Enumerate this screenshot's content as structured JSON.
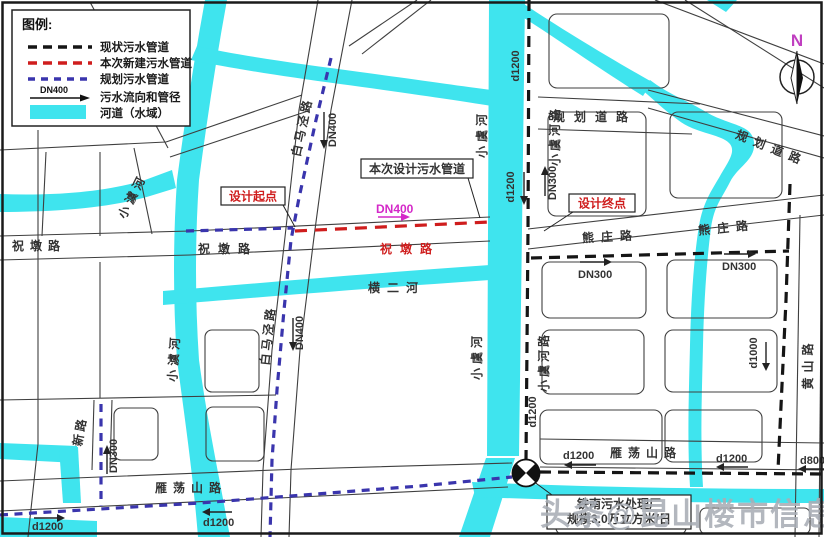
{
  "legend": {
    "title": "图例:",
    "existing": "现状污水管道",
    "new_build": "本次新建污水管道",
    "planned": "规划污水管道",
    "flow": "污水流向和管径",
    "flow_pipe": "DN400",
    "river": "河道（水域）",
    "colors": {
      "existing": "#151515",
      "new_build": "#cf1d1d",
      "planned": "#3a35ad",
      "river": "#3FE4EE"
    }
  },
  "compass": {
    "north": "N",
    "color": "#c03fc0"
  },
  "callouts": {
    "design_pipe": "本次设计污水管道",
    "design_start": "设计起点",
    "design_end": "设计终点",
    "new_pipe_size": "DN400",
    "plant_name": "铁南污水处理厂",
    "plant_scale": "规模3.0万立方米/日"
  },
  "roads": {
    "zhudun_w": "祝墩路",
    "zhudun_m": "祝墩路",
    "zhudun_red": "祝墩路",
    "baimajing_n": "白马泾路",
    "baimajing_s": "白马泾路",
    "xinlu": "新路",
    "yandangshan_w": "雁荡山路",
    "yandangshan_e": "雁荡山路",
    "xiongzhuang_w": "熊庄路",
    "xiongzhuang_e": "熊庄路",
    "xiaoyuhelu_n": "小虞河路",
    "xiaoyuhelu_s": "小虞河路",
    "huangshan": "黄山路",
    "guihua_h": "规划道路",
    "guihua_d": "规划道路"
  },
  "rivers": {
    "xiaoyuhe_n": "小虞河",
    "xiaoyuhe_s": "小虞河",
    "xiaoaohe_n": "小澞河",
    "xiaoaohe_s": "小澞河",
    "hengerhe": "横二河"
  },
  "pipes": {
    "d1200_river": "d1200",
    "d1200_mid": "d1200",
    "d1200_s": "d1200",
    "dn300_xyhl": "DN300",
    "dn400_bmj_n": "DN400",
    "dn400_bmj_s": "DN400",
    "dn300_xz_w": "DN300",
    "dn300_xz_e": "DN300",
    "dn300_xinlu": "DN300",
    "d1000": "d1000",
    "d1200_ydl_w": "d1200",
    "d1200_ydl_e": "d1200",
    "d800": "d800",
    "d1200_bl": "d1200",
    "d1200_bm": "d1200"
  },
  "watermark": "头条@昆山楼市信息"
}
